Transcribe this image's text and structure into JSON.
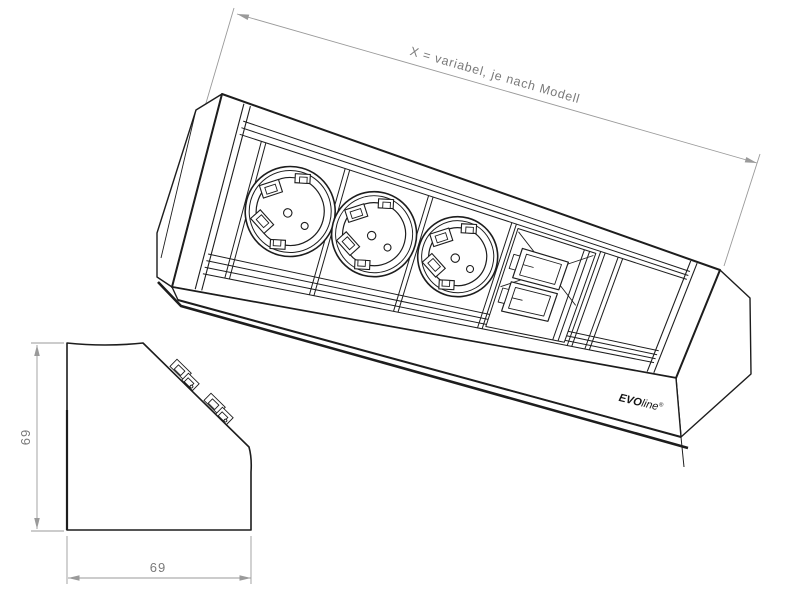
{
  "drawing": {
    "type": "technical-drawing",
    "product": "corner-mounted power strip",
    "components": {
      "schuko_sockets": 3,
      "data_ports": 2
    }
  },
  "dimensions": {
    "length_label": "X = variabel, je nach Modell",
    "height_label": "69",
    "width_label": "69"
  },
  "brand": {
    "part1": "EVO",
    "part2": "line",
    "mark": "®"
  },
  "colors": {
    "line": "#1d1d1d",
    "dim_line": "#9a9a9a",
    "dim_text": "#7a7a7a",
    "background": "#ffffff"
  }
}
